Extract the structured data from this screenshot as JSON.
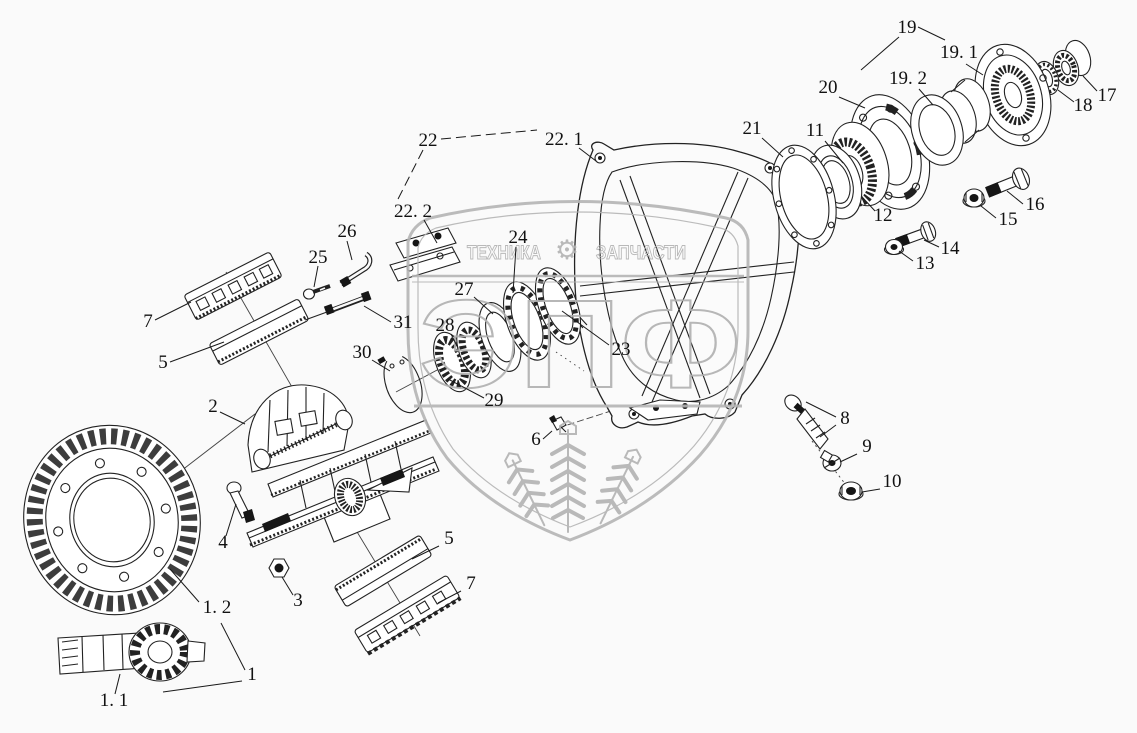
{
  "diagram": {
    "type": "exploded-parts-diagram",
    "subject": "drive axle final drive / differential assembly",
    "colors": {
      "background": "#fafafa",
      "line": "#222222",
      "watermark": "#b5b5b5"
    },
    "watermark": {
      "band_left_text": "ТЕХНИКА",
      "band_right_text": "ЗАПЧАСТИ",
      "gear_icon": "⚙",
      "logo_letters": "ЭПФ"
    },
    "callouts": [
      {
        "label": "22",
        "x": 428,
        "y": 146,
        "leaders": [
          [
            441,
            139,
            537,
            130,
            1
          ],
          [
            423,
            150,
            396,
            203,
            1
          ]
        ]
      },
      {
        "label": "22. 1",
        "x": 564,
        "y": 145,
        "leaders": [
          [
            579,
            148,
            596,
            161
          ]
        ]
      },
      {
        "label": "22. 2",
        "x": 413,
        "y": 217,
        "leaders": [
          [
            424,
            220,
            437,
            243
          ]
        ]
      },
      {
        "label": "26",
        "x": 347,
        "y": 237,
        "leaders": [
          [
            347,
            241,
            352,
            260
          ]
        ]
      },
      {
        "label": "25",
        "x": 318,
        "y": 263,
        "leaders": [
          [
            318,
            266,
            314,
            287
          ]
        ]
      },
      {
        "label": "24",
        "x": 518,
        "y": 243,
        "leaders": [
          [
            516,
            247,
            513,
            293
          ]
        ]
      },
      {
        "label": "27",
        "x": 464,
        "y": 295,
        "leaders": [
          [
            474,
            297,
            493,
            314
          ]
        ]
      },
      {
        "label": "28",
        "x": 445,
        "y": 331,
        "leaders": [
          [
            451,
            334,
            458,
            348
          ]
        ]
      },
      {
        "label": "29",
        "x": 494,
        "y": 406,
        "leaders": [
          [
            484,
            398,
            448,
            379
          ]
        ]
      },
      {
        "label": "30",
        "x": 362,
        "y": 358,
        "leaders": [
          [
            372,
            360,
            390,
            371
          ]
        ]
      },
      {
        "label": "31",
        "x": 403,
        "y": 328,
        "leaders": [
          [
            391,
            322,
            364,
            306
          ]
        ]
      },
      {
        "label": "23",
        "x": 621,
        "y": 355,
        "leaders": [
          [
            609,
            345,
            562,
            311
          ]
        ]
      },
      {
        "label": "7",
        "x": 148,
        "y": 327,
        "leaders": [
          [
            155,
            320,
            191,
            302
          ]
        ]
      },
      {
        "label": "5",
        "x": 163,
        "y": 368,
        "leaders": [
          [
            170,
            362,
            224,
            342
          ]
        ]
      },
      {
        "label": "2",
        "x": 213,
        "y": 412,
        "leaders": [
          [
            220,
            412,
            245,
            424
          ]
        ]
      },
      {
        "label": "4",
        "x": 223,
        "y": 548,
        "leaders": [
          [
            226,
            536,
            236,
            504
          ]
        ]
      },
      {
        "label": "3",
        "x": 298,
        "y": 606,
        "leaders": [
          [
            293,
            595,
            282,
            577
          ]
        ]
      },
      {
        "label": "5",
        "x": 449,
        "y": 544,
        "leaders": [
          [
            439,
            546,
            412,
            559
          ]
        ]
      },
      {
        "label": "7",
        "x": 471,
        "y": 589,
        "leaders": [
          [
            461,
            591,
            438,
            603
          ]
        ]
      },
      {
        "label": "1. 2",
        "x": 217,
        "y": 613,
        "leaders": [
          [
            199,
            602,
            170,
            569
          ]
        ]
      },
      {
        "label": "1",
        "x": 252,
        "y": 680,
        "leaders": [
          [
            245,
            670,
            221,
            623
          ],
          [
            242,
            681,
            163,
            692
          ]
        ]
      },
      {
        "label": "1. 1",
        "x": 114,
        "y": 706,
        "leaders": [
          [
            115,
            694,
            120,
            674
          ]
        ]
      },
      {
        "label": "6",
        "x": 536,
        "y": 445,
        "leaders": [
          [
            543,
            439,
            552,
            431
          ]
        ]
      },
      {
        "label": "8",
        "x": 845,
        "y": 424,
        "leaders": [
          [
            836,
            417,
            806,
            402
          ],
          [
            836,
            425,
            820,
            437
          ]
        ]
      },
      {
        "label": "9",
        "x": 867,
        "y": 452,
        "leaders": [
          [
            857,
            454,
            840,
            462
          ]
        ]
      },
      {
        "label": "10",
        "x": 892,
        "y": 487,
        "leaders": [
          [
            880,
            489,
            862,
            492
          ]
        ]
      },
      {
        "label": "19",
        "x": 907,
        "y": 33,
        "leaders": [
          [
            899,
            37,
            861,
            70
          ],
          [
            918,
            27,
            945,
            40
          ]
        ]
      },
      {
        "label": "19. 1",
        "x": 959,
        "y": 58,
        "leaders": [
          [
            966,
            64,
            983,
            75
          ]
        ]
      },
      {
        "label": "19. 2",
        "x": 908,
        "y": 84,
        "leaders": [
          [
            919,
            89,
            933,
            105
          ]
        ]
      },
      {
        "label": "18",
        "x": 1083,
        "y": 111,
        "leaders": [
          [
            1074,
            102,
            1058,
            90
          ]
        ]
      },
      {
        "label": "17",
        "x": 1107,
        "y": 101,
        "leaders": [
          [
            1097,
            91,
            1083,
            76
          ]
        ]
      },
      {
        "label": "20",
        "x": 828,
        "y": 93,
        "leaders": [
          [
            839,
            97,
            865,
            108
          ]
        ]
      },
      {
        "label": "21",
        "x": 752,
        "y": 134,
        "leaders": [
          [
            762,
            138,
            783,
            157
          ]
        ]
      },
      {
        "label": "11",
        "x": 815,
        "y": 136,
        "leaders": [
          [
            825,
            141,
            843,
            163
          ]
        ]
      },
      {
        "label": "12",
        "x": 883,
        "y": 221,
        "leaders": [
          [
            875,
            211,
            863,
            198
          ]
        ]
      },
      {
        "label": "16",
        "x": 1035,
        "y": 210,
        "leaders": [
          [
            1023,
            204,
            1007,
            191
          ]
        ]
      },
      {
        "label": "15",
        "x": 1008,
        "y": 225,
        "leaders": [
          [
            996,
            218,
            981,
            206
          ]
        ]
      },
      {
        "label": "14",
        "x": 950,
        "y": 254,
        "leaders": [
          [
            939,
            247,
            924,
            240
          ]
        ]
      },
      {
        "label": "13",
        "x": 925,
        "y": 269,
        "leaders": [
          [
            913,
            261,
            899,
            251
          ]
        ]
      }
    ]
  }
}
